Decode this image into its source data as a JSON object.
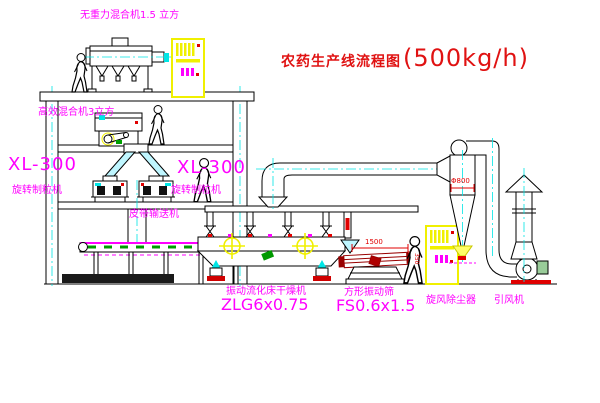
{
  "title": {
    "text": "农药生产线流程图",
    "capacity": "(500kg/h)"
  },
  "labels": {
    "top_mixer": "无重力混合机1.5 立方",
    "high_eff_mixer": "高效混合机3立方",
    "granulator_left_model": "XL-300",
    "granulator_left_name": "旋转制粒机",
    "granulator_right_model": "XL-300",
    "granulator_right_name": "旋转制粒机",
    "belt_conveyor": "皮带输送机",
    "dryer_name": "振动流化床干燥机",
    "dryer_model": "ZLG6x0.75",
    "screen_name": "方形振动筛",
    "screen_model": "FS0.6x1.5",
    "cyclone": "旋风除尘器",
    "fan": "引风机"
  },
  "dimensions": {
    "cyclone_diameter": "Φ800",
    "screen_length": "1500",
    "screen_height": "350"
  },
  "colors": {
    "label": "#ff00ff",
    "title": "#e01212",
    "dimension": "#e00000",
    "line": "#000000",
    "centerline": "#00e5e5",
    "cabinet": "#f0f000",
    "highlight": "#ffff00"
  }
}
